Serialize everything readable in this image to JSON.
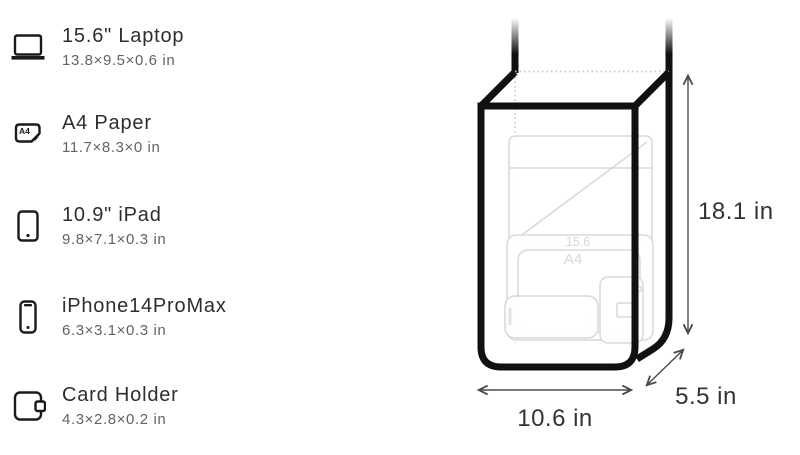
{
  "items": [
    {
      "name": "15.6\" Laptop",
      "dims": "13.8×9.5×0.6 in",
      "icon": "laptop-icon"
    },
    {
      "name": "A4 Paper",
      "dims": "11.7×8.3×0 in",
      "icon": "a4-paper-icon",
      "icon_label": "A4"
    },
    {
      "name": "10.9\" iPad",
      "dims": "9.8×7.1×0.3 in",
      "icon": "ipad-icon"
    },
    {
      "name": "iPhone14ProMax",
      "dims": "6.3×3.1×0.3 in",
      "icon": "iphone-icon"
    },
    {
      "name": "Card Holder",
      "dims": "4.3×2.8×0.2 in",
      "icon": "card-holder-icon"
    }
  ],
  "bag": {
    "height_label": "18.1 in",
    "width_label": "10.6 in",
    "depth_label": "5.5 in",
    "interior_labels": {
      "laptop": "15.6",
      "paper": "A4"
    }
  },
  "colors": {
    "ink": "#111111",
    "text_primary": "#2e2e2e",
    "text_secondary": "#636363",
    "sketch_gray": "#d8d8d8"
  }
}
